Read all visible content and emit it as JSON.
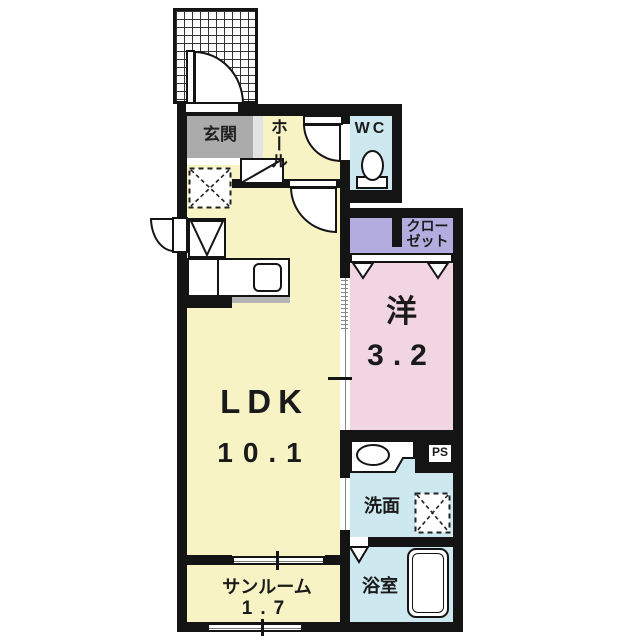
{
  "plan": {
    "type": "apartment-floor-plan",
    "unit_note": "room sizes in tatami mats as printed on plan"
  },
  "colors": {
    "floor_cream": "#F8F3C5",
    "genkan_gray": "#ABABAB",
    "water_blue": "#CDE9EF",
    "closet_purple": "#B3ADDF",
    "bedroom_pink": "#F1D5E1",
    "wall_black": "#141414"
  },
  "rooms": {
    "genkan": {
      "label": "玄関"
    },
    "hall": {
      "label": "ホール"
    },
    "wc": {
      "label": "WC"
    },
    "closet": {
      "line1": "クロー",
      "line2": "ゼット"
    },
    "western": {
      "label": "洋",
      "size": "3.2"
    },
    "ldk": {
      "label": "LDK",
      "size": "10.1"
    },
    "washroom": {
      "label": "洗面"
    },
    "ps": {
      "label": "PS"
    },
    "bathroom": {
      "label": "浴室"
    },
    "sunroom": {
      "label": "サンルーム",
      "size": "1.7"
    }
  },
  "fixtures": [
    "entrance-porch-tiles",
    "entrance-door",
    "hall-door",
    "ldk-door",
    "kitchen-back-door",
    "shoe-cabinet",
    "refrigerator-space",
    "stove",
    "kitchen-counter",
    "kitchen-sink",
    "toilet",
    "vanity-sink",
    "washing-machine-space",
    "bathtub",
    "closet-folding-doors",
    "bathroom-folding-door",
    "sliding-door-bedroom",
    "sliding-door-washroom",
    "sunroom-window-top",
    "sunroom-window-bottom"
  ]
}
